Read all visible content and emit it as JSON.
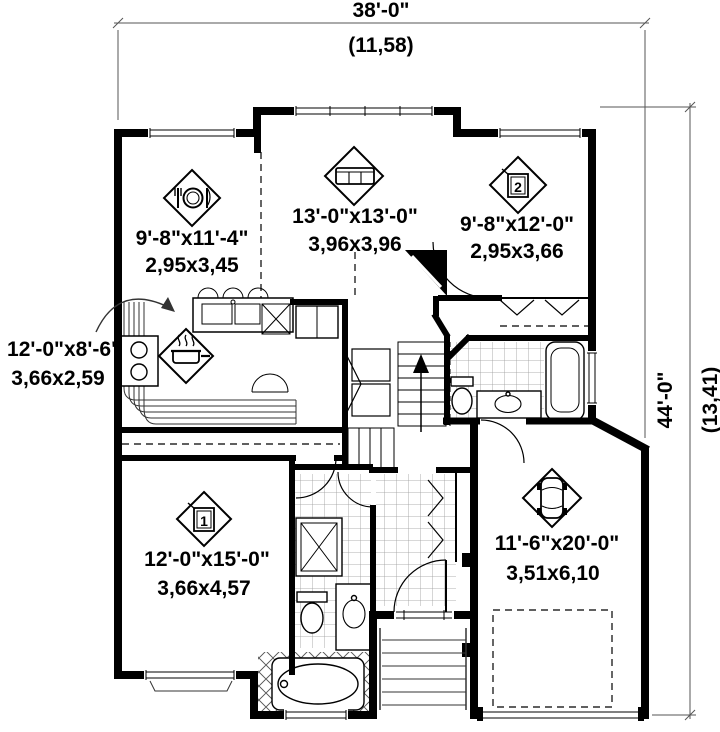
{
  "plan": {
    "type": "floor-plan",
    "overall_dimensions": {
      "width_imperial": "38'-0\"",
      "width_metric": "(11,58)",
      "height_imperial": "44'-0\"",
      "height_metric": "(13,41)"
    }
  },
  "rooms": [
    {
      "id": "dining-room",
      "icon": "dining-icon",
      "imperial": "9'-8\"x11'-4\"",
      "metric": "2,95x3,45"
    },
    {
      "id": "living-room",
      "icon": "sofa-icon",
      "imperial": "13'-0\"x13'-0\"",
      "metric": "3,96x3,96"
    },
    {
      "id": "bedroom-2",
      "icon": "bed-icon",
      "number": "2",
      "imperial": "9'-8\"x12'-0\"",
      "metric": "2,95x3,66"
    },
    {
      "id": "kitchen",
      "icon": "cooking-icon",
      "imperial": "12'-0\"x8'-6\"",
      "metric": "3,66x2,59"
    },
    {
      "id": "bedroom-1",
      "icon": "bed-icon",
      "number": "1",
      "imperial": "12'-0\"x15'-0\"",
      "metric": "3,66x4,57"
    },
    {
      "id": "garage",
      "icon": "car-icon",
      "imperial": "11'-6\"x20'-0\"",
      "metric": "3,51x6,10"
    }
  ],
  "colors": {
    "wall": "#000000",
    "line": "#333333",
    "dimension": "#555555",
    "background": "#ffffff"
  }
}
